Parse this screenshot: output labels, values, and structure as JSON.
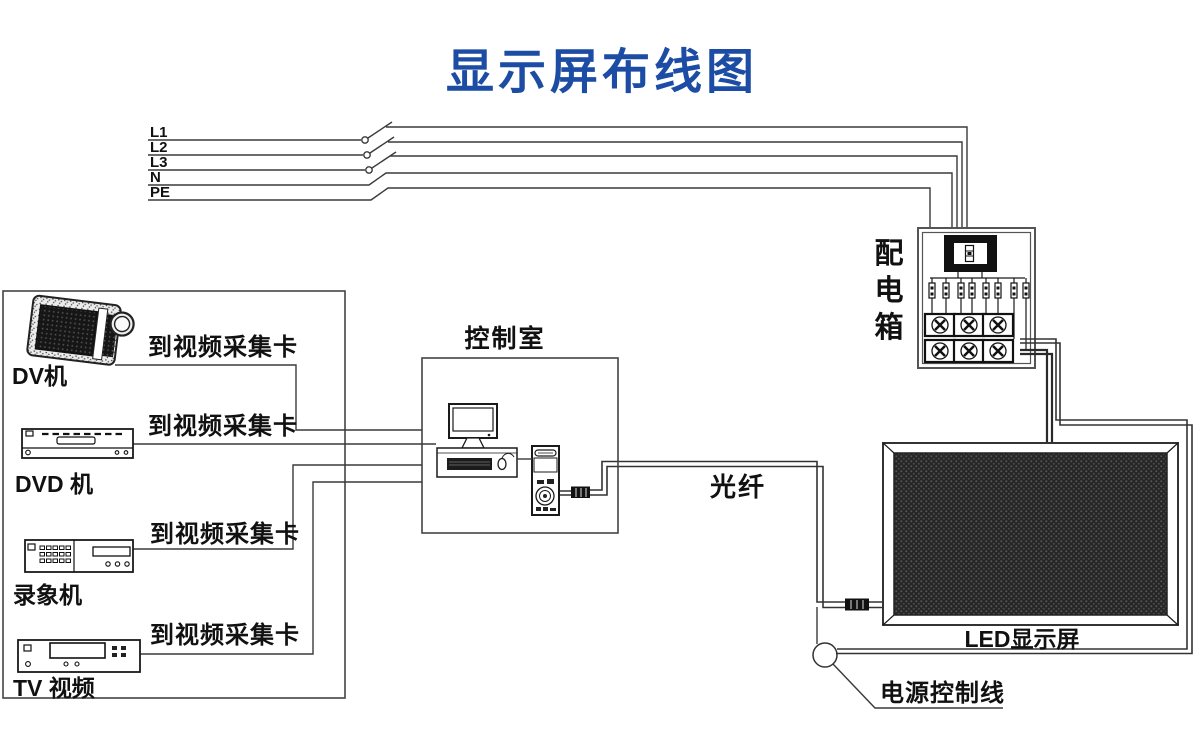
{
  "title": "显示屏布线图",
  "colors": {
    "title_blue": "#1c4ca3",
    "wire": "#3a3a3a",
    "ink": "#1a1a1a",
    "screen_dark": "#262626"
  },
  "power_lines": {
    "labels": [
      "L1",
      "L2",
      "L3",
      "N",
      "PE"
    ]
  },
  "distribution_box": {
    "label": "配电箱",
    "chars": [
      "配",
      "电",
      "箱"
    ]
  },
  "control_room": {
    "label": "控制室"
  },
  "sources": [
    {
      "label": "DV机",
      "wire_label": "到视频采集卡"
    },
    {
      "label": "DVD 机",
      "wire_label": "到视频采集卡"
    },
    {
      "label": "录象机",
      "wire_label": "到视频采集卡"
    },
    {
      "label": "TV 视频",
      "wire_label": "到视频采集卡"
    }
  ],
  "fiber": {
    "label": "光纤"
  },
  "led": {
    "label": "LED显示屏"
  },
  "power_control": {
    "label": "电源控制线"
  }
}
